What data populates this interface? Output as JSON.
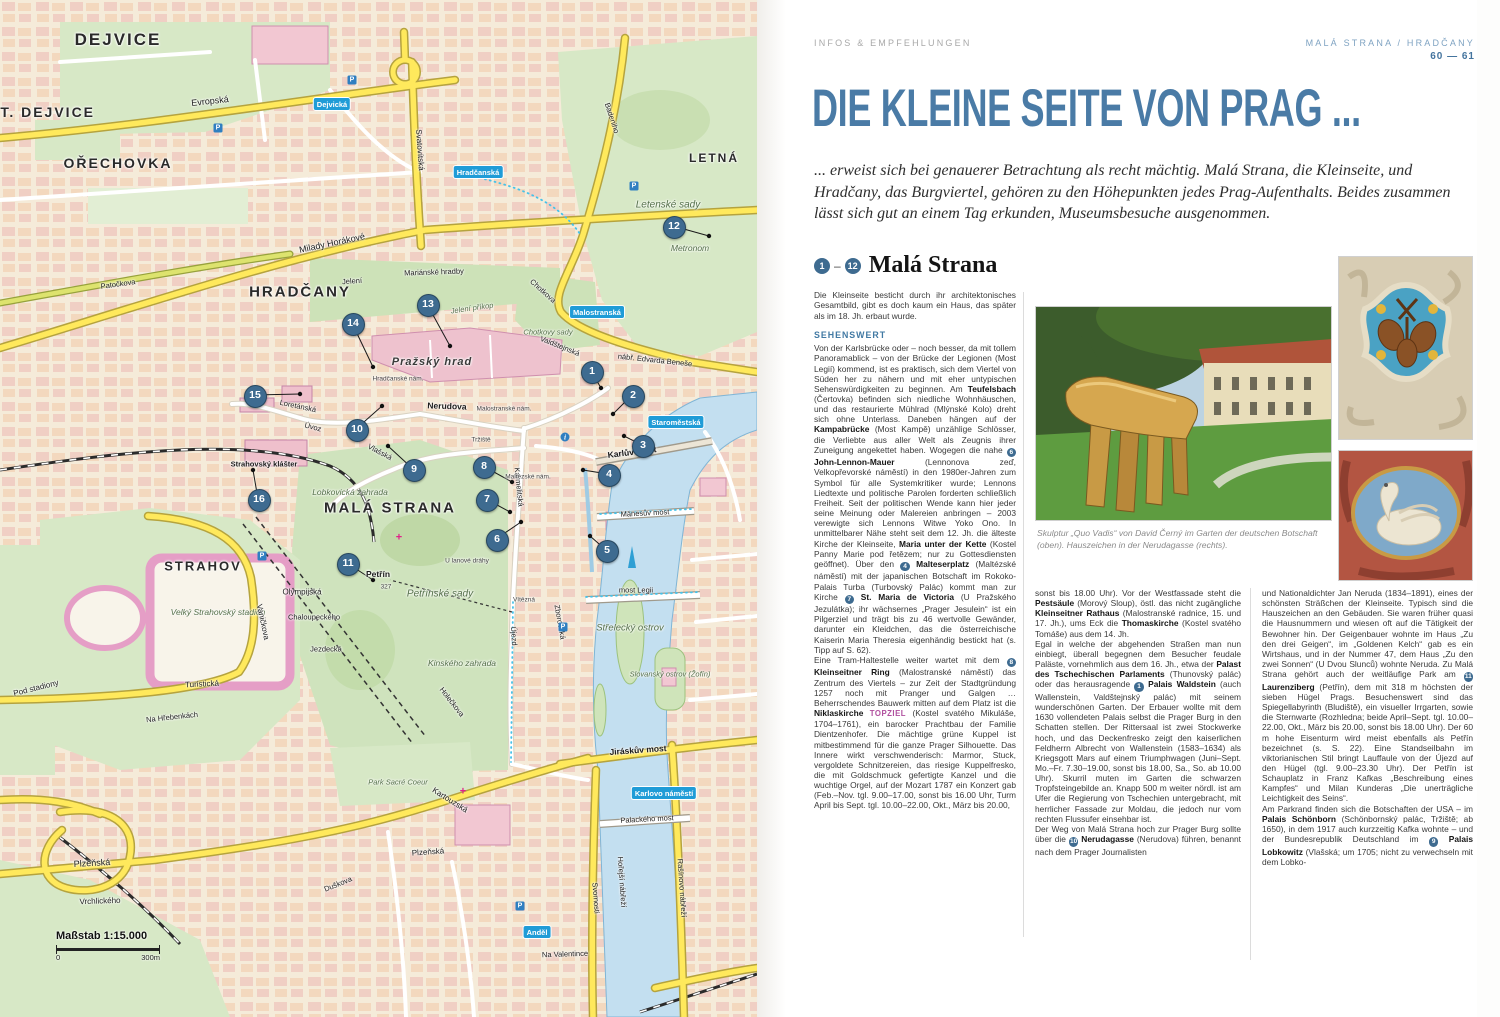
{
  "article": {
    "kicker": "INFOS & EMPFEHLUNGEN",
    "section_label": "MALÁ STRANA / HRADČANY",
    "pages": "60 — 61",
    "title": "DIE KLEINE SEITE VON PRAG ...",
    "intro": "... erweist sich bei genauerer Betrachtung als recht mächtig. Malá Strana, die Kleinseite, und Hradčany, das Burgviertel, gehören zu den Höhepunkten jedes Prag-Aufenthalts. Beides zusammen lässt sich gut an einem Tag erkunden, Museumsbesuche ausgenommen.",
    "range_from": "1",
    "range_to": "12",
    "heading": "Malá Strana",
    "lead": "Die Kleinseite besticht durch ihr architektonisches Gesamtbild, gibt es doch kaum ein Haus, das später als im 18. Jh. erbaut wurde.",
    "subhead": "SEHENSWERT",
    "col1_html": "Von der Karlsbrücke oder – noch besser, da mit tollem Panoramablick – von der Brücke der Legionen (Most Legií) kommend, ist es praktisch, sich dem Viertel von Süden her zu nähern und mit eher untypischen Sehenswürdigkeiten zu beginnen. Am <b>Teufelsbach</b> (Čertovka) befinden sich niedliche Wohnhäuschen, und das restaurierte Mühlrad (Mlýnské Kolo) dreht sich ohne Unterlass. Daneben hängen auf der <b>Kampabrücke</b> (Most Kampě) unzählige Schlösser, die Verliebte aus aller Welt als Zeugnis ihrer Zuneigung angekettet haben. Wogegen die nahe <span class='mk'>6</span> <b>John-Lennon-Mauer</b> (Lennonova zeď, Velkopřevorské náměstí) in den 1980er-Jahren zum Symbol für alle Systemkritiker wurde; Lennons Liedtexte und politische Parolen forderten schließlich Freiheit. Seit der politischen Wende kann hier jeder seine Meinung oder Malereien anbringen – 2003 verewigte sich Lennons Witwe Yoko Ono. In unmittelbarer Nähe steht seit dem 12. Jh. die älteste Kirche der Kleinseite, <b>Maria unter der Kette</b> (Kostel Panny Marie pod řetězem; nur zu Gottesdiensten geöffnet). Über den <span class='mk'>4</span> <b>Malteserplatz</b> (Maltézské náměstí) mit der japanischen Botschaft im Rokoko-Palais Turba (Turbovský Palác) kommt man zur Kirche <span class='mk'>7</span> <b>St. Maria de Victoria</b> (U Pražského Jezulátka); ihr wächsernes „Prager Jesulein“ ist ein Pilgerziel und trägt bis zu 46 wertvolle Gewänder, darunter ein Kleidchen, das die österreichische Kaiserin Maria Theresia eigenhändig bestickt hat (s. Tipp auf S. 62).<br>Eine Tram-Haltestelle weiter wartet mit dem <span class='mk'>8</span> <b>Kleinseitner Ring</b> (Malostranské náměstí) das Zentrum des Viertels – zur Zeit der Stadtgründung 1257 noch mit Pranger und Galgen … Beherrschendes Bauwerk mitten auf dem Platz ist die <b>Niklaskirche</b> <span class='tz'>TOPZIEL</span> (Kostel svatého Mikuláše, 1704–1761), ein barocker Prachtbau der Familie Dientzenhofer. Die mächtige grüne Kuppel ist mitbestimmend für die ganze Prager Silhouette. Das Innere wirkt verschwenderisch: Marmor, Stuck, vergoldete Schnitzereien, das riesige Kuppelfresko, die mit Goldschmuck gefertigte Kanzel und die wuchtige Orgel, auf der Mozart 1787 ein Konzert gab (Feb.–Nov. tgl. 9.00–17.00, sonst bis 16.00 Uhr, Turm April bis Sept. tgl. 10.00–22.00, Okt., März bis 20.00,",
    "col2_html": "sonst bis 18.00 Uhr). Vor der Westfassade steht die <b>Pestsäule</b> (Morový Sloup), östl. das nicht zugängliche <b>Kleinseitner Rathaus</b> (Malostranské radnice, 15. und 17. Jh.), ums Eck die <b>Thomaskirche</b> (Kostel svatého Tomáše) aus dem 14. Jh.<br>Egal in welche der abgehenden Straßen man nun einbiegt, überall begegnen dem Besucher feudale Paläste, vornehmlich aus dem 16. Jh., etwa der <b>Palast des Tschechischen Parlaments</b> (Thunovský palác) oder das herausragende <span class='mk'>1</span> <b>Palais Waldstein</b> (auch Wallenstein, Valdštejnský palác) mit seinem wunderschönen Garten. Der Erbauer wollte mit dem 1630 vollendeten Palais selbst die Prager Burg in den Schatten stellen. Der Rittersaal ist zwei Stockwerke hoch, und das Deckenfresko zeigt den kaiserlichen Feldherrn Albrecht von Wallenstein (1583–1634) als Kriegsgott Mars auf einem Triumphwagen (Juni–Sept. Mo.–Fr. 7.30–19.00, sonst bis 18.00, Sa., So. ab 10.00 Uhr). Skurril muten im Garten die schwarzen Tropfsteingebilde an. Knapp 500 m weiter nördl. ist am Ufer die Regierung von Tschechien untergebracht, mit herrlicher Fassade zur Moldau, die jedoch nur vom rechten Flussufer einsehbar ist.<br>Der Weg von Malá Strana hoch zur Prager Burg sollte über die <span class='mk'>10</span> <b>Nerudagasse</b> (Nerudova) führen, benannt nach dem Prager Journalisten",
    "col3_html": "und Nationaldichter Jan Neruda (1834–1891), eines der schönsten Sträßchen der Kleinseite. Typisch sind die Hauszeichen an den Gebäuden. Sie waren früher quasi die Hausnummern und wiesen oft auf die Tätigkeit der Bewohner hin. Der Geigenbauer wohnte im Haus „Zu den drei Geigen“, im „Goldenen Kelch“ gab es ein Wirtshaus, und in der Nummer 47, dem Haus „Zu den zwei Sonnen“ (U Dvou Slunců) wohnte Neruda. Zu Malá Strana gehört auch der weitläufige Park am <span class='mk'>11</span> <b>Laurenziberg</b> (Petřín), dem mit 318 m höchsten der sieben Hügel Prags. Besuchenswert sind das Spiegellabyrinth (Bludiště), ein visueller Irrgarten, sowie die Sternwarte (Rozhledna; beide April–Sept. tgl. 10.00–22.00, Okt., März bis 20.00, sonst bis 18.00 Uhr). Der 60 m hohe Eisenturm wird meist ebenfalls als Petřín bezeichnet (s. S. 22). Eine Standseilbahn im viktorianischen Stil bringt Lauffaule von der Újezd auf den Hügel (tgl. 9.00–23.30 Uhr). Der Petřín ist Schauplatz in Franz Kafkas „Beschreibung eines Kampfes“ und Milan Kunderas „Die unerträgliche Leichtigkeit des Seins“.<br>Am Parkrand finden sich die Botschaften der USA – im <b>Palais Schönborn</b> (Schönbornský palác, Tržiště; ab 1650), in dem 1917 auch kurzzeitig Kafka wohnte – und der Bundesrepublik Deutschland im <span class='mk'>9</span> <b>Palais Lobkowitz</b> (Vlašská; um 1705; nicht zu verwechseln mit dem Lobko-",
    "caption": "Skulptur „Quo Vadis“ von David Černý im Garten der deutschen Botschaft (oben). Hauszeichen in der Nerudagasse (rechts)."
  },
  "map": {
    "scale_label": "Maßstab 1:15.000",
    "scale_start": "0",
    "scale_end": "300m",
    "labels": [
      {
        "t": "DEJVICE",
        "x": 118,
        "y": 40,
        "c": "d",
        "s": 17
      },
      {
        "t": "ST. DEJVICE",
        "x": 42,
        "y": 112,
        "c": "d",
        "s": 14
      },
      {
        "t": "OŘECHOVKA",
        "x": 118,
        "y": 163,
        "c": "d",
        "s": 14
      },
      {
        "t": "HRADČANY",
        "x": 300,
        "y": 292,
        "c": "d",
        "s": 15
      },
      {
        "t": "MALÁ STRANA",
        "x": 390,
        "y": 508,
        "c": "d",
        "s": 15
      },
      {
        "t": "STRAHOV",
        "x": 203,
        "y": 566,
        "c": "d",
        "s": 13
      },
      {
        "t": "LETNÁ",
        "x": 714,
        "y": 158,
        "c": "d",
        "s": 12
      },
      {
        "t": "Letenské sady",
        "x": 668,
        "y": 205,
        "c": "p",
        "s": 10
      },
      {
        "t": "Metronom",
        "x": 690,
        "y": 248,
        "c": "p"
      },
      {
        "t": "Petřínské sady",
        "x": 440,
        "y": 594,
        "c": "p",
        "s": 10
      },
      {
        "t": "Kinského zahrada",
        "x": 462,
        "y": 663,
        "c": "p"
      },
      {
        "t": "Lobkovická zahrada",
        "x": 350,
        "y": 492,
        "c": "p"
      },
      {
        "t": "Velký Strahovský stadión",
        "x": 218,
        "y": 612,
        "c": "p"
      },
      {
        "t": "Chotkovy sady",
        "x": 548,
        "y": 332,
        "c": "p",
        "s": 7.5
      },
      {
        "t": "Jelení příkop",
        "x": 472,
        "y": 308,
        "c": "p",
        "r": -8,
        "s": 7.5
      },
      {
        "t": "Park Sacré Coeur",
        "x": 398,
        "y": 782,
        "c": "p",
        "s": 7.5
      },
      {
        "t": "Střelecký ostrov",
        "x": 630,
        "y": 628,
        "c": "p",
        "s": 9.5
      },
      {
        "t": "Slovanský ostrov (Žofín)",
        "x": 670,
        "y": 674,
        "c": "p",
        "s": 7.5
      },
      {
        "t": "Pražský hrad",
        "x": 432,
        "y": 362,
        "c": "h"
      },
      {
        "t": "Strahovský klášter",
        "x": 264,
        "y": 464,
        "c": "sb",
        "s": 7.5
      },
      {
        "t": "Petřín",
        "x": 378,
        "y": 574,
        "c": "sb"
      },
      {
        "t": "327",
        "x": 386,
        "y": 587,
        "c": "t"
      },
      {
        "t": "Evropská",
        "x": 210,
        "y": 101,
        "r": -6,
        "s": 9
      },
      {
        "t": "Milady Horákové",
        "x": 332,
        "y": 243,
        "r": -12,
        "s": 9
      },
      {
        "t": "Patočkova",
        "x": 118,
        "y": 284,
        "r": -8
      },
      {
        "t": "Svatovítská",
        "x": 420,
        "y": 150,
        "r": 86,
        "s": 8
      },
      {
        "t": "Chotkova",
        "x": 543,
        "y": 291,
        "r": 42
      },
      {
        "t": "Badeniho",
        "x": 612,
        "y": 118,
        "r": 72
      },
      {
        "t": "nábř. Edvarda Beneše",
        "x": 655,
        "y": 360,
        "r": 6
      },
      {
        "t": "Karlův most",
        "x": 632,
        "y": 452,
        "r": -7,
        "c": "sb"
      },
      {
        "t": "Mánesův most",
        "x": 645,
        "y": 513,
        "r": -3
      },
      {
        "t": "most Legii",
        "x": 636,
        "y": 590
      },
      {
        "t": "Jiráskův most",
        "x": 638,
        "y": 750,
        "r": -4,
        "c": "sb"
      },
      {
        "t": "Palackého most",
        "x": 647,
        "y": 819,
        "r": -3
      },
      {
        "t": "Nerudova",
        "x": 447,
        "y": 406,
        "r": 2,
        "c": "sb"
      },
      {
        "t": "Vlašská",
        "x": 380,
        "y": 452,
        "r": 28
      },
      {
        "t": "Úvoz",
        "x": 313,
        "y": 427,
        "r": 14
      },
      {
        "t": "Loretánská",
        "x": 298,
        "y": 406,
        "r": 12
      },
      {
        "t": "Karmelitská",
        "x": 519,
        "y": 487,
        "r": 84
      },
      {
        "t": "Újezd",
        "x": 514,
        "y": 636,
        "r": 86
      },
      {
        "t": "Turistická",
        "x": 202,
        "y": 684,
        "r": -3,
        "s": 8
      },
      {
        "t": "Vaničkova",
        "x": 263,
        "y": 622,
        "r": 78,
        "s": 8
      },
      {
        "t": "Plzeňská",
        "x": 92,
        "y": 863,
        "r": -3,
        "s": 9
      },
      {
        "t": "Plzeňská",
        "x": 428,
        "y": 852,
        "r": -4,
        "s": 8
      },
      {
        "t": "Vrchlického",
        "x": 100,
        "y": 901,
        "r": -2,
        "s": 8
      },
      {
        "t": "Duškova",
        "x": 338,
        "y": 884,
        "r": -22
      },
      {
        "t": "Kartouzská",
        "x": 450,
        "y": 800,
        "r": 32,
        "s": 8
      },
      {
        "t": "Svornosti",
        "x": 596,
        "y": 898,
        "r": 86
      },
      {
        "t": "Hořejší nábřeží",
        "x": 622,
        "y": 882,
        "r": 86
      },
      {
        "t": "Rašínovo nábřeží",
        "x": 682,
        "y": 888,
        "r": 86
      },
      {
        "t": "Olympijská",
        "x": 302,
        "y": 592,
        "s": 8
      },
      {
        "t": "Chaloupeckého",
        "x": 314,
        "y": 617
      },
      {
        "t": "Jezdecká",
        "x": 326,
        "y": 649
      },
      {
        "t": "Na Hřebenkách",
        "x": 172,
        "y": 717,
        "r": -6
      },
      {
        "t": "Pod stadiony",
        "x": 36,
        "y": 688,
        "r": -14,
        "s": 8
      },
      {
        "t": "Hradčanské nám.",
        "x": 398,
        "y": 379,
        "c": "t"
      },
      {
        "t": "Malostranské nám.",
        "x": 504,
        "y": 409,
        "c": "t"
      },
      {
        "t": "Maltézské nám.",
        "x": 528,
        "y": 477,
        "c": "t"
      },
      {
        "t": "Tržiště",
        "x": 481,
        "y": 440,
        "c": "t"
      },
      {
        "t": "Valdštejnská",
        "x": 560,
        "y": 346,
        "r": 22
      },
      {
        "t": "U lanové dráhy",
        "x": 467,
        "y": 561,
        "c": "t"
      },
      {
        "t": "Mariánské hradby",
        "x": 434,
        "y": 272,
        "r": -2
      },
      {
        "t": "Jelení",
        "x": 352,
        "y": 281,
        "r": -4
      },
      {
        "t": "Vítězná",
        "x": 524,
        "y": 600,
        "c": "t"
      },
      {
        "t": "Zborovská",
        "x": 560,
        "y": 622,
        "r": 80
      },
      {
        "t": "Holečkova",
        "x": 452,
        "y": 702,
        "r": 52
      },
      {
        "t": "Na Valentince",
        "x": 565,
        "y": 954,
        "r": -2
      }
    ],
    "metro": [
      {
        "t": "Hradčanská",
        "x": 478,
        "y": 172
      },
      {
        "t": "Dejvická",
        "x": 332,
        "y": 104
      },
      {
        "t": "Malostranská",
        "x": 597,
        "y": 312
      },
      {
        "t": "Staroměstská",
        "x": 676,
        "y": 422
      },
      {
        "t": "Karlovo náměstí",
        "x": 664,
        "y": 793
      },
      {
        "t": "Anděl",
        "x": 537,
        "y": 932
      }
    ],
    "pois": [
      {
        "k": "P",
        "x": 352,
        "y": 80
      },
      {
        "k": "P",
        "x": 218,
        "y": 128
      },
      {
        "k": "P",
        "x": 634,
        "y": 186
      },
      {
        "k": "P",
        "x": 563,
        "y": 627
      },
      {
        "k": "P",
        "x": 520,
        "y": 906
      },
      {
        "k": "P",
        "x": 262,
        "y": 556
      },
      {
        "k": "+",
        "x": 399,
        "y": 538
      },
      {
        "k": "+",
        "x": 463,
        "y": 792
      },
      {
        "k": "i",
        "x": 565,
        "y": 437
      }
    ],
    "markers": [
      {
        "n": "1",
        "x": 591,
        "y": 371,
        "tx": 601,
        "ty": 388
      },
      {
        "n": "2",
        "x": 632,
        "y": 395,
        "tx": 613,
        "ty": 414
      },
      {
        "n": "3",
        "x": 642,
        "y": 445,
        "tx": 624,
        "ty": 436
      },
      {
        "n": "4",
        "x": 608,
        "y": 474,
        "tx": 583,
        "ty": 470
      },
      {
        "n": "5",
        "x": 606,
        "y": 550,
        "tx": 590,
        "ty": 536
      },
      {
        "n": "6",
        "x": 496,
        "y": 539,
        "tx": 521,
        "ty": 522
      },
      {
        "n": "7",
        "x": 486,
        "y": 499,
        "tx": 510,
        "ty": 512
      },
      {
        "n": "8",
        "x": 483,
        "y": 466,
        "tx": 512,
        "ty": 482
      },
      {
        "n": "9",
        "x": 413,
        "y": 469,
        "tx": 388,
        "ty": 446
      },
      {
        "n": "10",
        "x": 356,
        "y": 429,
        "tx": 382,
        "ty": 406
      },
      {
        "n": "11",
        "x": 347,
        "y": 563,
        "tx": 373,
        "ty": 580
      },
      {
        "n": "12",
        "x": 673,
        "y": 226,
        "tx": 709,
        "ty": 236
      },
      {
        "n": "13",
        "x": 427,
        "y": 304,
        "tx": 450,
        "ty": 346
      },
      {
        "n": "14",
        "x": 352,
        "y": 323,
        "tx": 373,
        "ty": 367
      },
      {
        "n": "15",
        "x": 254,
        "y": 395,
        "tx": 300,
        "ty": 394
      },
      {
        "n": "16",
        "x": 258,
        "y": 499,
        "tx": 253,
        "ty": 470
      }
    ]
  },
  "colors": {
    "title_blue": "#4a7ba6",
    "subhead_blue": "#4179a3",
    "topziel_magenta": "#b04f9e",
    "marker_blue": "#3e6b90",
    "metro_blue": "#1f9cd7",
    "road_yellow": "#ffe95c",
    "water_blue": "#c3dff0",
    "park_green": "#d7e8c6"
  }
}
